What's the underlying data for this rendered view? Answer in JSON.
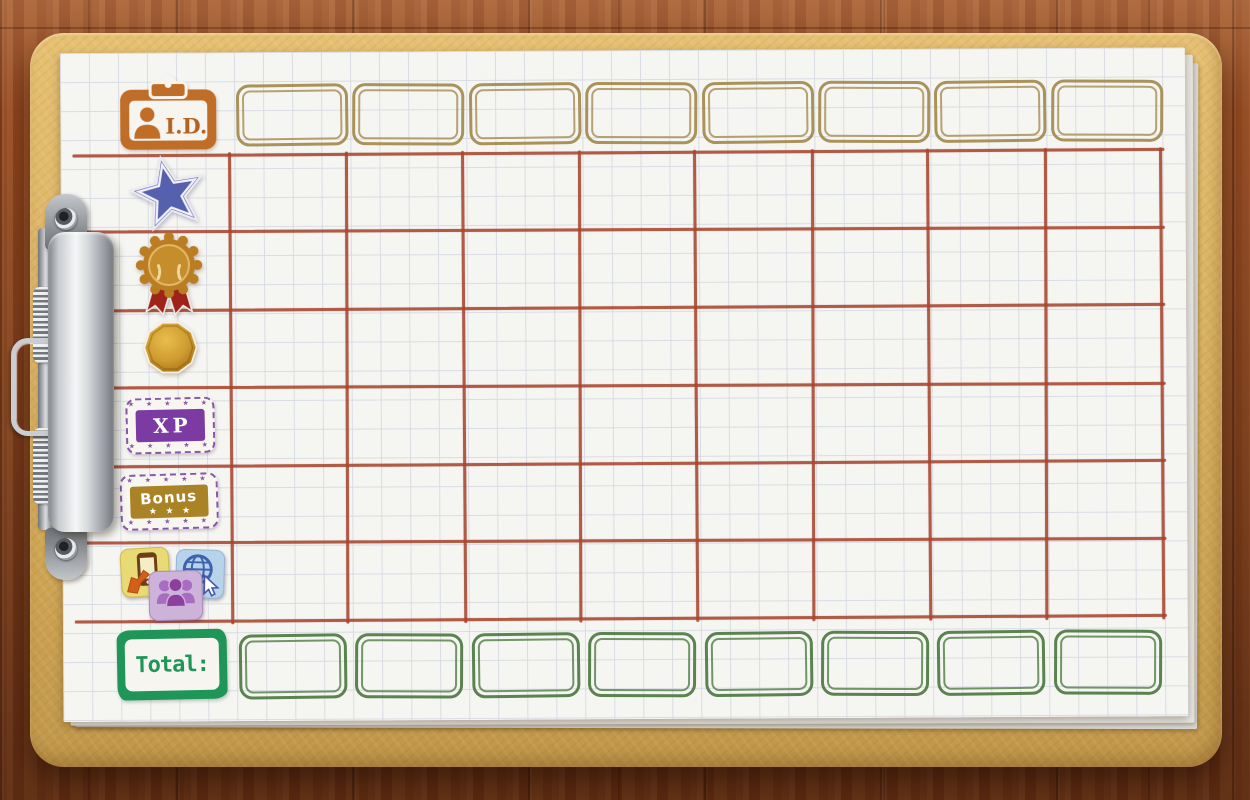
{
  "board": {
    "columns": 8,
    "header_row": {
      "icon": "id-badge-icon",
      "label": "I.D.",
      "cells": [
        "",
        "",
        "",
        "",
        "",
        "",
        "",
        ""
      ]
    },
    "score_rows": [
      {
        "name": "stars",
        "icon": "star-icon"
      },
      {
        "name": "medal",
        "icon": "medal-icon"
      },
      {
        "name": "coins",
        "icon": "coin-icon"
      },
      {
        "name": "xp",
        "icon": "xp-stamp-icon",
        "label": "XP"
      },
      {
        "name": "bonus",
        "icon": "bonus-stamp-icon",
        "label": "Bonus",
        "stars": "★ ★ ★"
      },
      {
        "name": "apps",
        "icon": "apps-stamp-icon"
      }
    ],
    "total_row": {
      "label": "Total:",
      "cells": [
        "",
        "",
        "",
        "",
        "",
        "",
        "",
        ""
      ]
    },
    "stamp_frame_stars_top": "★ ★ ★ ★ ★",
    "stamp_frame_stars_bottom": "★ ★ ★ ★ ★"
  },
  "colors": {
    "grid_line": "#a7462f",
    "header_box": "#a48a4f",
    "total_box": "#4e7a42",
    "total_stamp": "#1f9657",
    "id_badge": "#c06d28",
    "star": "#5560ae",
    "medal_gold": "#bb7d22",
    "medal_ribbon": "#9e241b",
    "coin_gold": "#cf9c30",
    "xp": "#7c3ba2",
    "stamp_frame": "#8a56a8",
    "bonus": "#aa8326",
    "app_yellow": "#e8da74",
    "app_blue": "#b7d3e9",
    "app_purple": "#cdb3da",
    "paper": "#f5f5f2",
    "clipboard": "#d8b161"
  }
}
